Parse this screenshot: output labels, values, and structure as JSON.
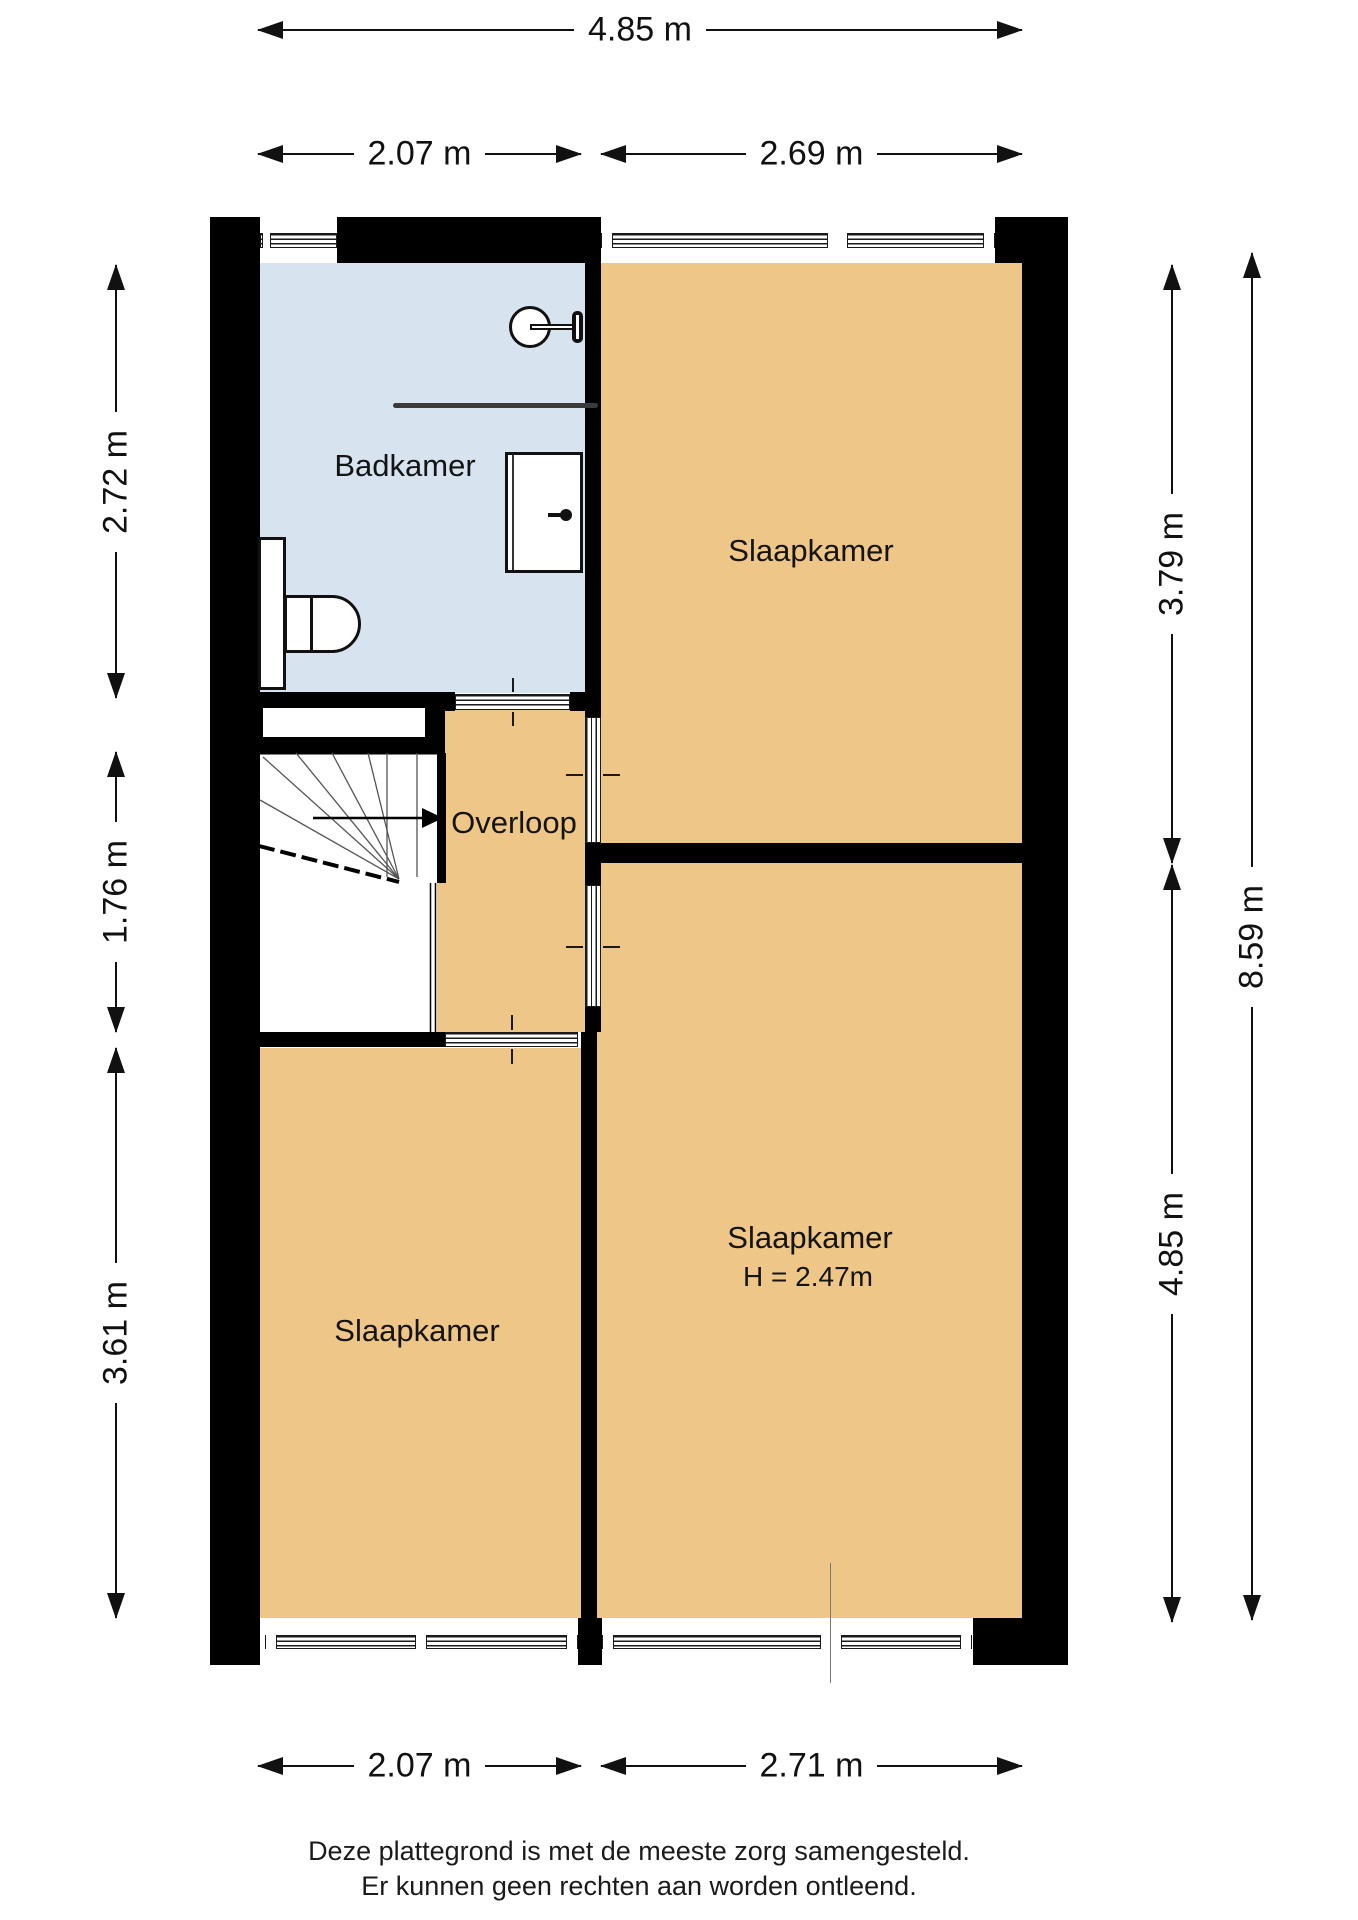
{
  "plan": {
    "rooms": {
      "badkamer": {
        "label": "Badkamer"
      },
      "slaapkamer_top_right": {
        "label": "Slaapkamer"
      },
      "overloop": {
        "label": "Overloop"
      },
      "slaapkamer_bottom_right": {
        "label": "Slaapkamer",
        "height_note": "H = 2.47m"
      },
      "slaapkamer_bottom_left": {
        "label": "Slaapkamer"
      }
    },
    "fixtures": {
      "shower": "shower-head",
      "rail": "towel-rail",
      "sink": "washbasin-with-tap",
      "toilet": "toilet-with-cistern",
      "stairs": "winder-staircase-with-direction-arrow"
    }
  },
  "dims": {
    "top_total": "4.85 m",
    "top_left": "2.07 m",
    "top_right": "2.69 m",
    "left_top": "2.72 m",
    "left_middle": "1.76 m",
    "left_bottom": "3.61 m",
    "right_top": "3.79 m",
    "right_total": "8.59 m",
    "right_bottom": "4.85 m",
    "bottom_left": "2.07 m",
    "bottom_right": "2.71 m"
  },
  "colors": {
    "wall": "#000000",
    "bathroom_fill": "#d7e4f0",
    "room_fill": "#eec687",
    "dim_line": "#111111"
  },
  "footer": {
    "line1": "Deze plattegrond is met de meeste zorg samengesteld.",
    "line2": "Er kunnen geen rechten aan worden ontleend."
  }
}
